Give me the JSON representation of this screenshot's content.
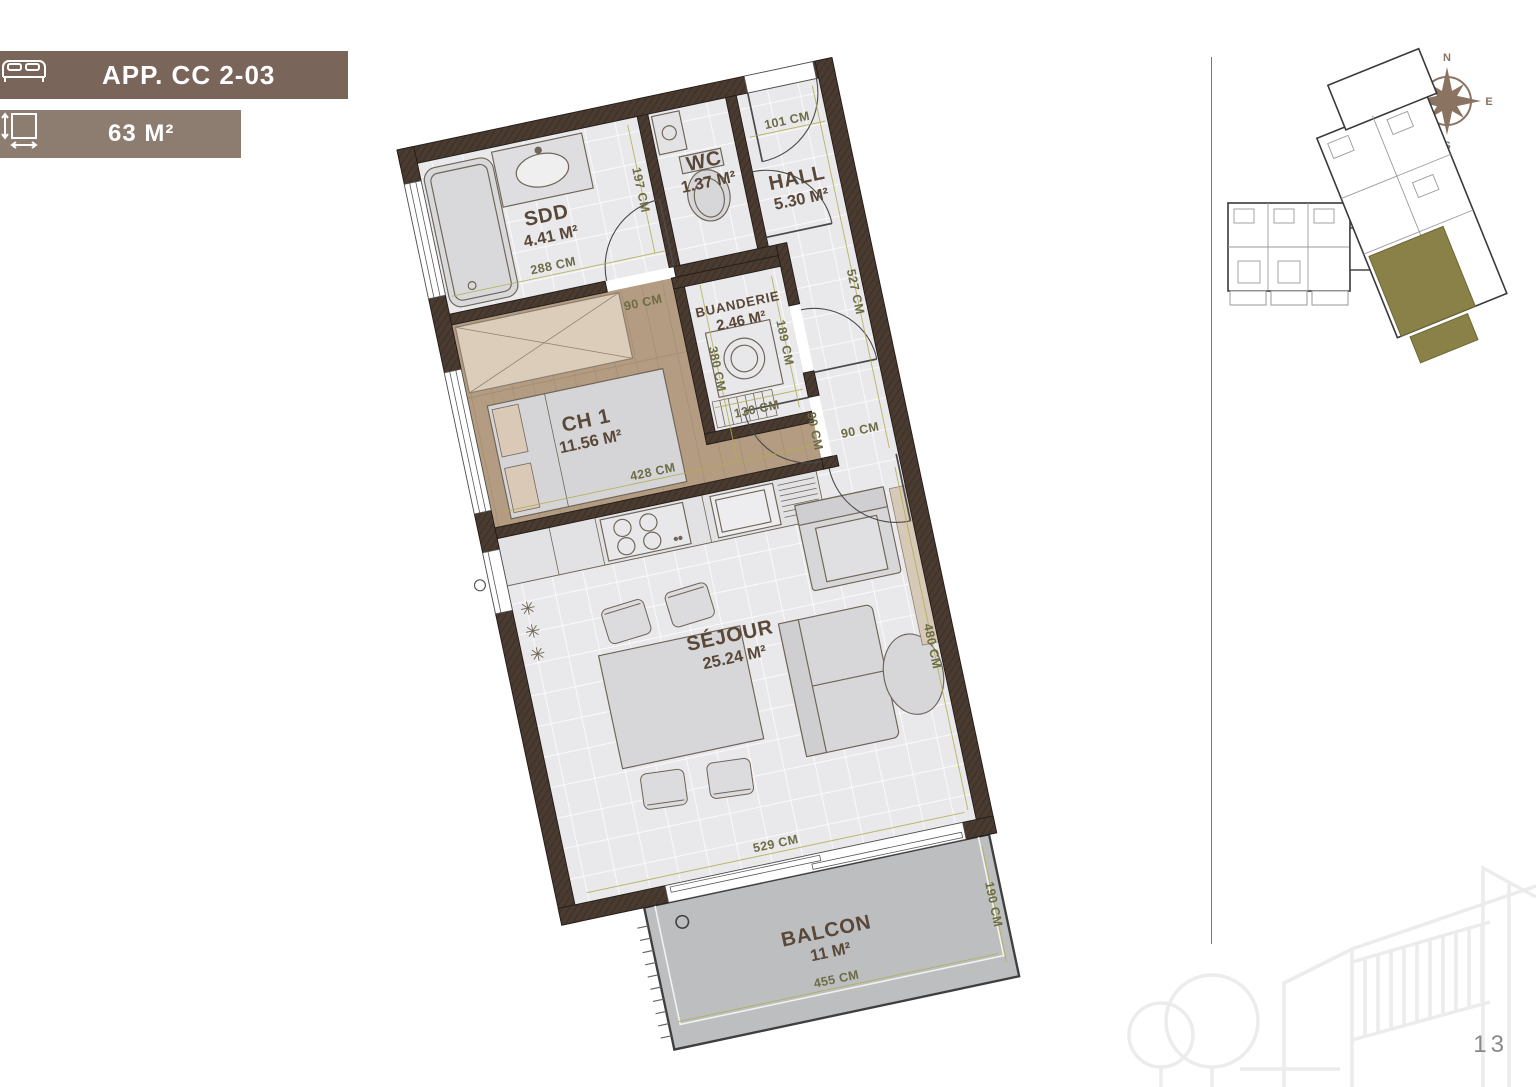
{
  "header": {
    "app_badge": {
      "label": "APP. CC 2-03",
      "icon": "bed-icon",
      "bg": "#7a655a"
    },
    "area_badge": {
      "label": "63 M²",
      "icon": "area-dimensions-icon",
      "bg": "#8c7d70"
    }
  },
  "floor_plan": {
    "rooms": {
      "sdd": {
        "name": "SDD",
        "area": "4.41 M²"
      },
      "wc": {
        "name": "WC",
        "area": "1.37 M²"
      },
      "hall": {
        "name": "HALL",
        "area": "5.30 M²"
      },
      "ch1": {
        "name": "CH 1",
        "area": "11.56 M²"
      },
      "buanderie": {
        "name": "BUANDERIE",
        "area": "2.46 M²"
      },
      "sejour": {
        "name": "SÉJOUR",
        "area": "25.24 M²"
      },
      "balcon": {
        "name": "BALCON",
        "area": "11 M²"
      }
    },
    "dimensions": {
      "sdd_width": "288 CM",
      "sdd_depth": "197 CM",
      "sdd_door": "90 CM",
      "hall_entry": "101 CM",
      "hall_length": "527 CM",
      "buanderie_depth": "189 CM",
      "buanderie_width": "130 CM",
      "ch1_depth": "380 CM",
      "ch1_width": "428 CM",
      "ch1_door": "90 CM",
      "sejour_door": "90 CM",
      "sejour_depth": "480 CM",
      "sejour_width": "529 CM",
      "balcon_depth": "190 CM",
      "balcon_width": "455 CM"
    }
  },
  "compass": {
    "north": "N",
    "east": "E",
    "south": "S",
    "west": "W"
  },
  "key_plan": {
    "highlight_color": "#8a8148"
  },
  "page": {
    "number": "13"
  },
  "colors": {
    "badge_primary": "#7a655a",
    "badge_secondary": "#8c7d70",
    "wall": "#4a3b31",
    "wood_floor": "#b49c82",
    "unit_highlight": "#8a8148",
    "dimension_text": "#6c6c45",
    "room_label": "#594738"
  }
}
